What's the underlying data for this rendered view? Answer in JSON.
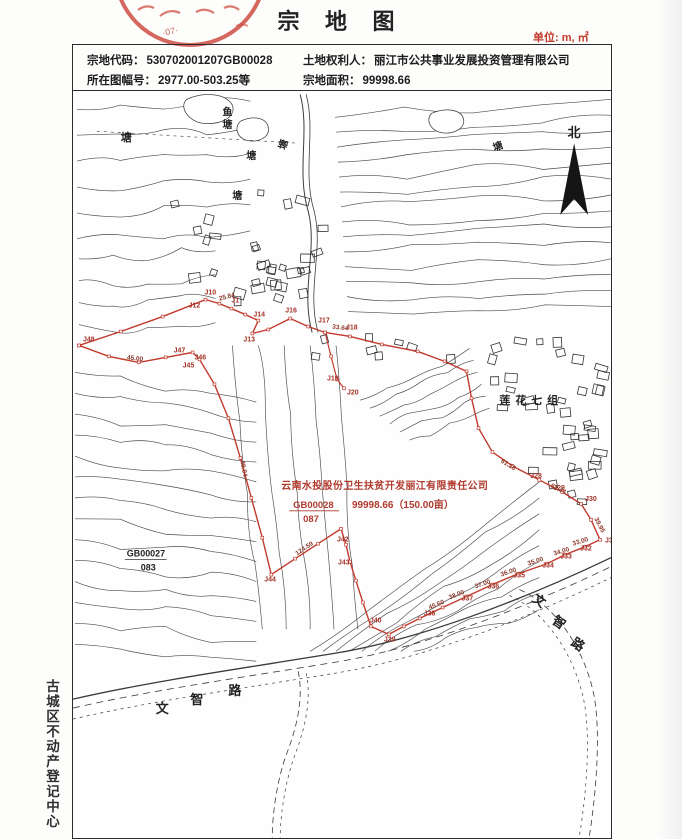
{
  "header": {
    "title": "宗 地 图",
    "unit": "单位: m, ㎡",
    "stamp": "red-official-seal"
  },
  "info_table": {
    "parcel_code_label": "宗地代码：",
    "parcel_code": "530702001207GB00028",
    "sheet_label": "所在图幅号：",
    "sheet": "2977.00-503.25等",
    "owner_label": "土地权利人：",
    "owner": "丽江市公共事业发展投资管理有限公司",
    "area_label": "宗地面积：",
    "area": "99998.66"
  },
  "sidebar": {
    "registry_text": "古城区不动产登记中心"
  },
  "map": {
    "north_label": "北",
    "boundary_color": "#c23a2c",
    "red_note": {
      "line1": "云南水投股份卫生扶贫开发丽江有限责任公司",
      "code": "GB00028",
      "subcode": "087",
      "area": "99998.66（150.00亩）"
    },
    "boundary": [
      [
        78,
        345
      ],
      [
        120,
        331
      ],
      [
        162,
        316
      ],
      [
        205,
        299
      ],
      [
        219,
        303
      ],
      [
        231,
        308
      ],
      [
        245,
        314
      ],
      [
        258,
        320
      ],
      [
        252,
        333
      ],
      [
        268,
        329
      ],
      [
        290,
        318
      ],
      [
        308,
        326
      ],
      [
        325,
        332
      ],
      [
        350,
        336
      ],
      [
        382,
        344
      ],
      [
        418,
        351
      ],
      [
        445,
        361
      ],
      [
        467,
        371
      ],
      [
        472,
        398
      ],
      [
        479,
        428
      ],
      [
        493,
        452
      ],
      [
        513,
        466
      ],
      [
        540,
        480
      ],
      [
        563,
        492
      ],
      [
        582,
        504
      ],
      [
        592,
        520
      ],
      [
        601,
        540
      ],
      [
        586,
        547
      ],
      [
        566,
        555
      ],
      [
        548,
        564
      ],
      [
        519,
        574
      ],
      [
        493,
        585
      ],
      [
        467,
        597
      ],
      [
        443,
        608
      ],
      [
        420,
        619
      ],
      [
        404,
        627
      ],
      [
        389,
        635
      ],
      [
        371,
        627
      ],
      [
        363,
        603
      ],
      [
        356,
        581
      ],
      [
        350,
        562
      ],
      [
        346,
        545
      ],
      [
        341,
        529
      ],
      [
        318,
        544
      ],
      [
        295,
        559
      ],
      [
        271,
        575
      ],
      [
        262,
        538
      ],
      [
        251,
        498
      ],
      [
        240,
        458
      ],
      [
        228,
        418
      ],
      [
        214,
        384
      ],
      [
        199,
        359
      ],
      [
        192,
        352
      ],
      [
        165,
        357
      ],
      [
        138,
        362
      ],
      [
        108,
        356
      ],
      [
        78,
        345
      ]
    ],
    "spur": [
      [
        325,
        332
      ],
      [
        331,
        356
      ],
      [
        337,
        379
      ],
      [
        344,
        388
      ]
    ],
    "point_labels": [
      {
        "t": "J1",
        "x": 231,
        "y": 302
      },
      {
        "t": "J10",
        "x": 204,
        "y": 294
      },
      {
        "t": "J12",
        "x": 188,
        "y": 307
      },
      {
        "t": "J14",
        "x": 253,
        "y": 316
      },
      {
        "t": "J13",
        "x": 243,
        "y": 341
      },
      {
        "t": "J16",
        "x": 285,
        "y": 312
      },
      {
        "t": "J17",
        "x": 318,
        "y": 322
      },
      {
        "t": "J18",
        "x": 346,
        "y": 329
      },
      {
        "t": "J19",
        "x": 327,
        "y": 380
      },
      {
        "t": "J20",
        "x": 347,
        "y": 394
      },
      {
        "t": "J28",
        "x": 531,
        "y": 478
      },
      {
        "t": "J29",
        "x": 554,
        "y": 490
      },
      {
        "t": "J30",
        "x": 586,
        "y": 501
      },
      {
        "t": "J31",
        "x": 606,
        "y": 543
      },
      {
        "t": "J32",
        "x": 581,
        "y": 551
      },
      {
        "t": "J33",
        "x": 561,
        "y": 559
      },
      {
        "t": "J34",
        "x": 543,
        "y": 568
      },
      {
        "t": "J35",
        "x": 514,
        "y": 578
      },
      {
        "t": "J36",
        "x": 488,
        "y": 589
      },
      {
        "t": "J37",
        "x": 462,
        "y": 601
      },
      {
        "t": "J38",
        "x": 424,
        "y": 616
      },
      {
        "t": "J39",
        "x": 384,
        "y": 642
      },
      {
        "t": "J40",
        "x": 370,
        "y": 623
      },
      {
        "t": "J42",
        "x": 337,
        "y": 542
      },
      {
        "t": "J43",
        "x": 338,
        "y": 565
      },
      {
        "t": "J44",
        "x": 264,
        "y": 582
      },
      {
        "t": "J45",
        "x": 182,
        "y": 367
      },
      {
        "t": "J46",
        "x": 194,
        "y": 359
      },
      {
        "t": "J47",
        "x": 173,
        "y": 352
      },
      {
        "t": "J48",
        "x": 82,
        "y": 341
      }
    ],
    "distance_labels": [
      {
        "t": "25.84",
        "x": 219,
        "y": 300,
        "r": -14
      },
      {
        "t": "33.64",
        "x": 332,
        "y": 328,
        "r": 7
      },
      {
        "t": "61.28",
        "x": 501,
        "y": 462,
        "r": 32
      },
      {
        "t": "61.44",
        "x": 551,
        "y": 487,
        "r": 27
      },
      {
        "t": "39.95",
        "x": 595,
        "y": 519,
        "r": 62
      },
      {
        "t": "33.00",
        "x": 574,
        "y": 546,
        "r": -17
      },
      {
        "t": "34.00",
        "x": 555,
        "y": 556,
        "r": -17
      },
      {
        "t": "35.00",
        "x": 529,
        "y": 566,
        "r": -18
      },
      {
        "t": "36.00",
        "x": 502,
        "y": 577,
        "r": -19
      },
      {
        "t": "37.00",
        "x": 476,
        "y": 589,
        "r": -19
      },
      {
        "t": "38.00",
        "x": 450,
        "y": 600,
        "r": -21
      },
      {
        "t": "45.60",
        "x": 430,
        "y": 610,
        "r": -22
      },
      {
        "t": "124.59",
        "x": 297,
        "y": 556,
        "r": -34
      },
      {
        "t": "45.00",
        "x": 126,
        "y": 359,
        "r": 6
      },
      {
        "t": "40.04",
        "x": 240,
        "y": 461,
        "r": 80
      }
    ],
    "place_labels": [
      {
        "t": "塘",
        "x": 120,
        "y": 140,
        "s": 11
      },
      {
        "t": "鱼",
        "x": 222,
        "y": 114,
        "s": 10
      },
      {
        "t": "塘",
        "x": 222,
        "y": 127,
        "s": 10
      },
      {
        "t": "塘",
        "x": 246,
        "y": 158,
        "s": 10
      },
      {
        "t": "塘",
        "x": 285,
        "y": 149,
        "s": 10,
        "r": -75
      },
      {
        "t": "塘",
        "x": 232,
        "y": 198,
        "s": 10
      },
      {
        "t": "塘",
        "x": 495,
        "y": 150,
        "s": 10,
        "r": -20
      },
      {
        "t": "GB00027",
        "x": 126,
        "y": 557,
        "s": 9
      },
      {
        "t": "083",
        "x": 140,
        "y": 571,
        "s": 9
      },
      {
        "t": "莲花七组",
        "x": 500,
        "y": 404,
        "s": 11,
        "ls": 5
      },
      {
        "t": "文",
        "x": 155,
        "y": 714,
        "s": 13
      },
      {
        "t": "智",
        "x": 190,
        "y": 705,
        "s": 13
      },
      {
        "t": "路",
        "x": 228,
        "y": 696,
        "s": 13
      },
      {
        "t": "文",
        "x": 532,
        "y": 601,
        "s": 13,
        "r": 35
      },
      {
        "t": "智",
        "x": 552,
        "y": 623,
        "s": 13,
        "r": 35
      },
      {
        "t": "路",
        "x": 571,
        "y": 645,
        "s": 13,
        "r": 35
      }
    ]
  }
}
